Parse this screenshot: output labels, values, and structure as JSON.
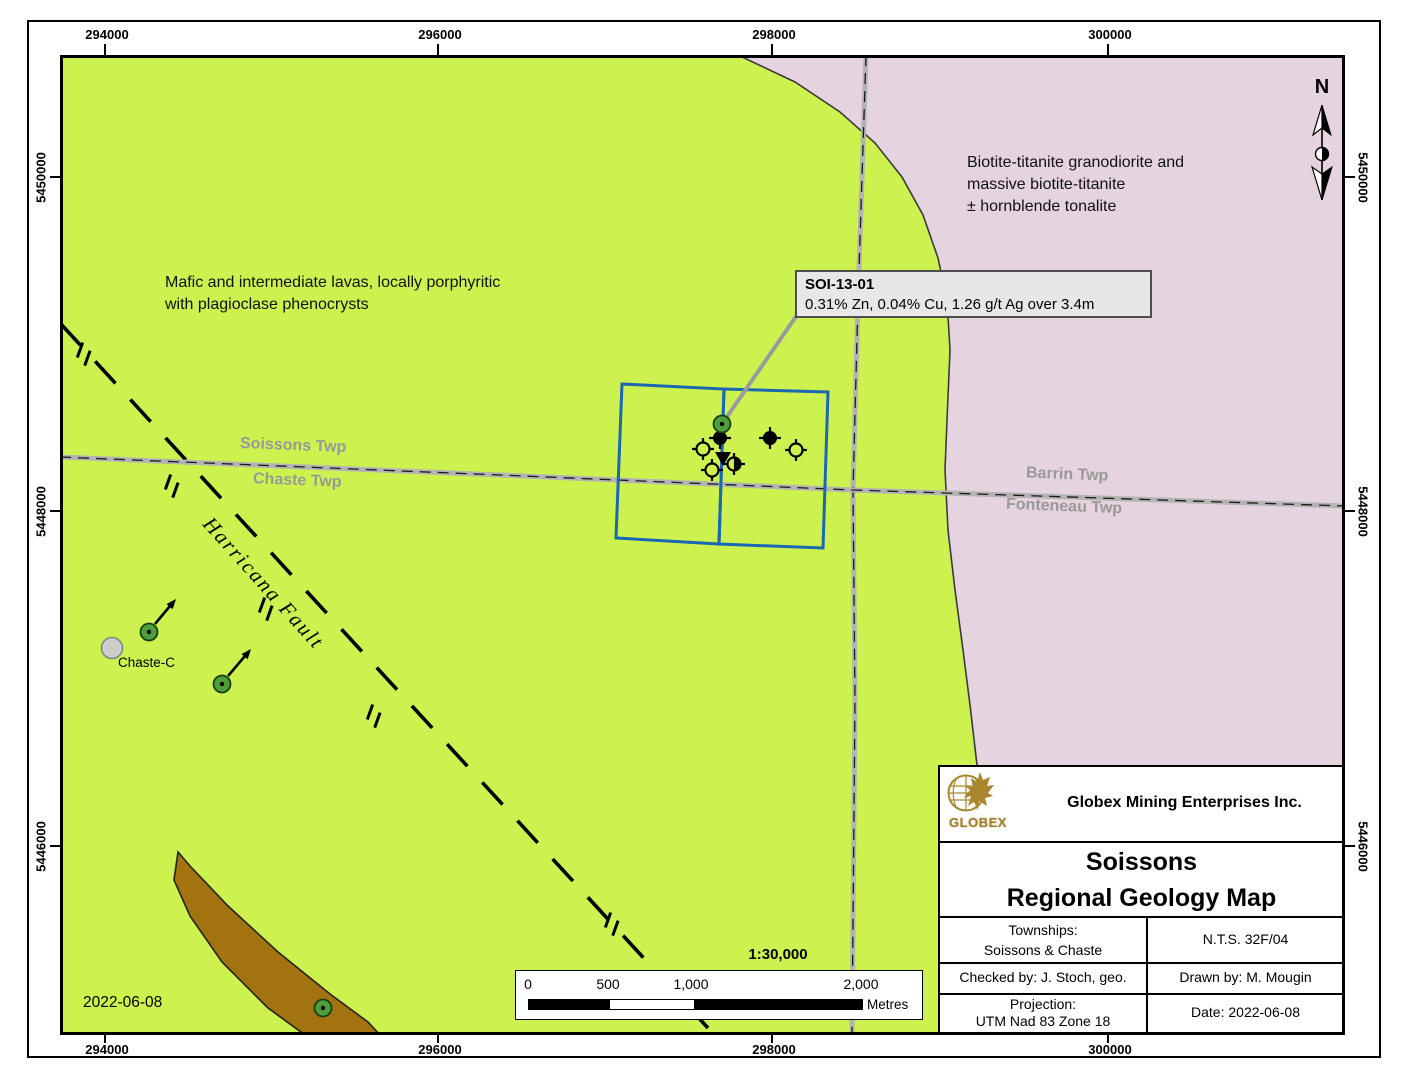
{
  "colors": {
    "lavas_green": "#cdf24f",
    "granodiorite_pink": "#e5d3df",
    "intrusive_brown": "#a2730e",
    "claim_blue": "#1b67b2",
    "road_gray": "#b3b3b3",
    "township_label_gray": "#999999",
    "logo_gold": "#a8862e"
  },
  "grid": {
    "top": [
      "294000",
      "296000",
      "298000",
      "300000"
    ],
    "bottom": [
      "294000",
      "296000",
      "298000",
      "300000"
    ],
    "left": [
      "5450000",
      "5448000",
      "5446000"
    ],
    "right": [
      "5450000",
      "5448000",
      "5446000"
    ]
  },
  "north": {
    "label": "N"
  },
  "units": {
    "mafic_line1": "Mafic and intermediate lavas, locally porphyritic",
    "mafic_line2": "with plagioclase phenocrysts",
    "granodiorite_line1": "Biotite-titanite granodiorite and",
    "granodiorite_line2": "massive biotite-titanite",
    "granodiorite_line3": "± hornblende tonalite"
  },
  "townships": {
    "soissons": "Soissons Twp",
    "chaste": "Chaste Twp",
    "barrin": "Barrin Twp",
    "fonteneau": "Fonteneau Twp"
  },
  "fault": {
    "label": "Harricana Fault"
  },
  "features": {
    "chaste_c": "Chaste-C"
  },
  "callout": {
    "title": "SOI-13-01",
    "body": "0.31% Zn, 0.04% Cu, 1.26 g/t Ag over 3.4m"
  },
  "map_date": "2022-06-08",
  "scalebar": {
    "ratio": "1:30,000",
    "t0": "0",
    "t500": "500",
    "t1000": "1,000",
    "t2000": "2,000",
    "unit": "Metres"
  },
  "titleblock": {
    "logo_text": "GLOBEX",
    "company": "Globex Mining Enterprises Inc.",
    "title_line1": "Soissons",
    "title_line2": "Regional Geology Map",
    "townships_label": "Townships:",
    "townships_value": "Soissons & Chaste",
    "nts": "N.T.S. 32F/04",
    "checked_by": "Checked by: J. Stoch, geo.",
    "drawn_by": "Drawn by: M. Mougin",
    "projection_label": "Projection:",
    "projection_value": "UTM Nad 83 Zone 18",
    "date": "Date: 2022-06-08"
  }
}
